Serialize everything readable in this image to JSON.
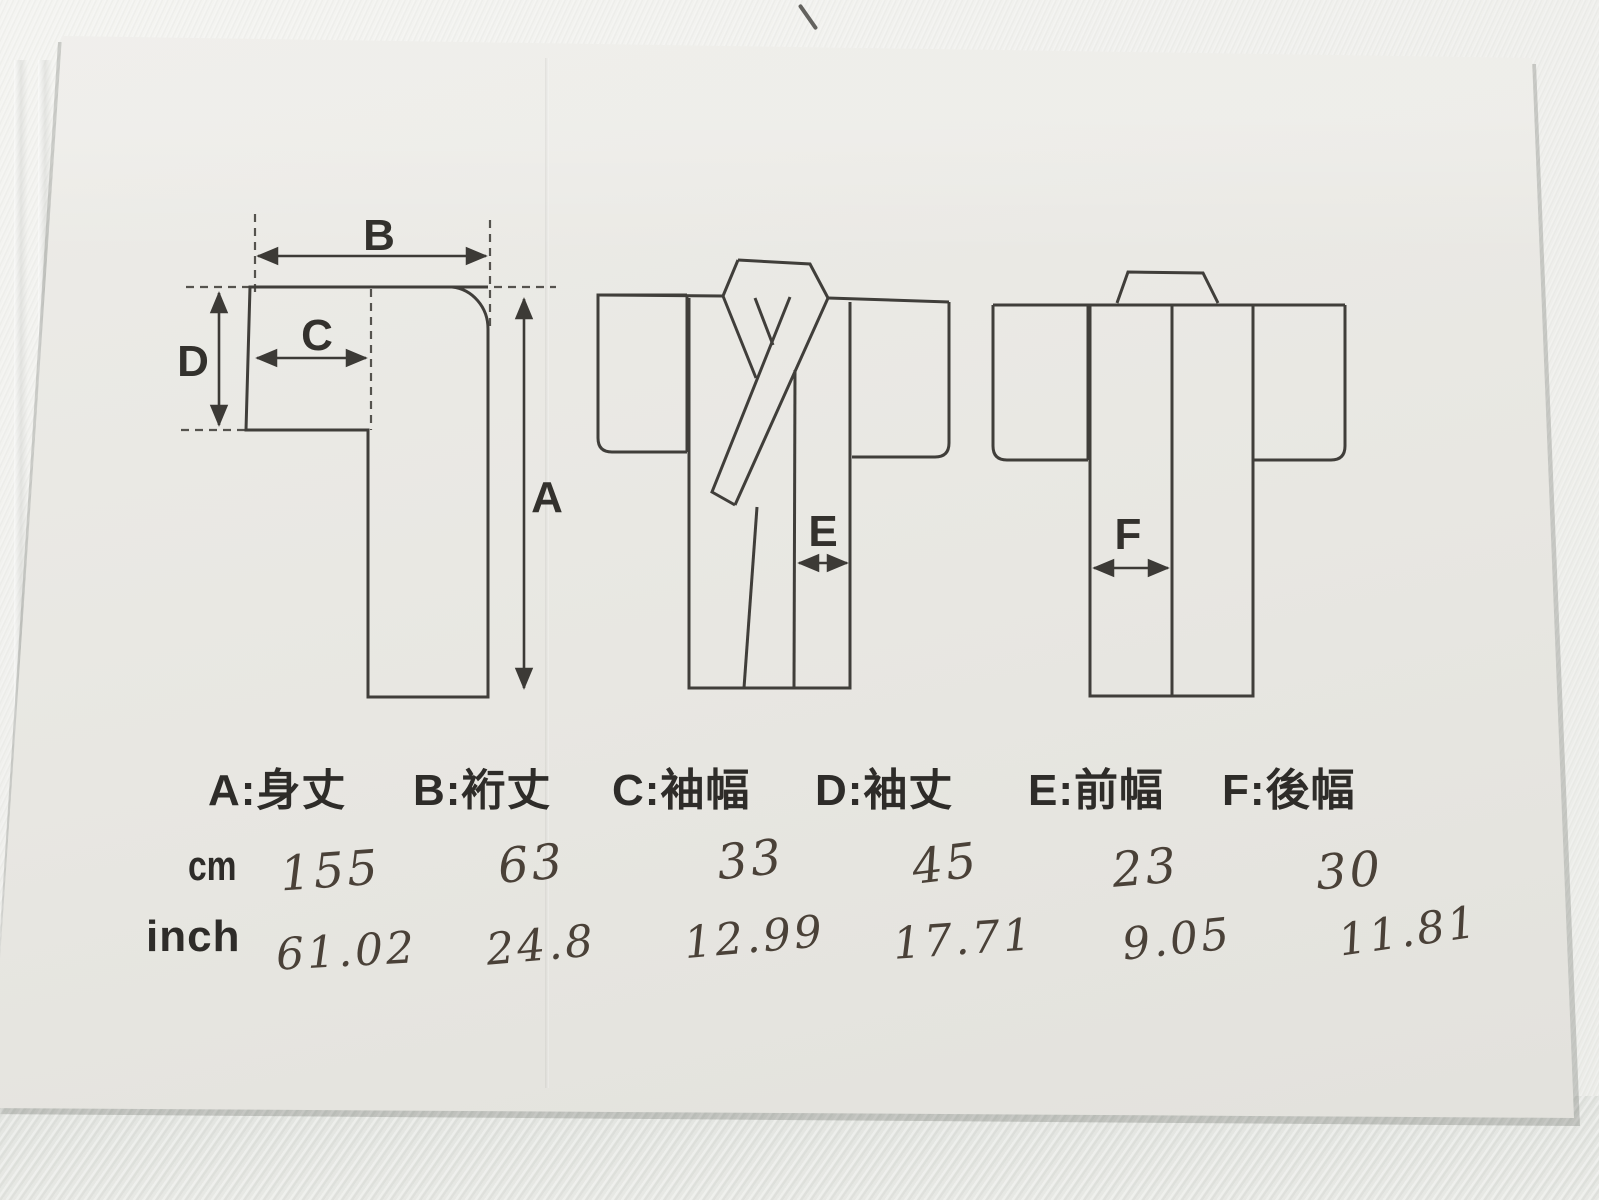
{
  "diagram": {
    "labels": {
      "a": "A",
      "b": "B",
      "c": "C",
      "d": "D",
      "e": "E",
      "f": "F"
    }
  },
  "legend": {
    "items": [
      "A:身丈",
      "B:裄丈",
      "C:袖幅",
      "D:袖丈",
      "E:前幅",
      "F:後幅"
    ]
  },
  "table": {
    "row_cm": {
      "label": "cm",
      "values": [
        "155",
        "63",
        "33",
        "45",
        "23",
        "30"
      ]
    },
    "row_inch": {
      "label": "inch",
      "values": [
        "61.02",
        "24.8",
        "12.99",
        "17.71",
        "9.05",
        "11.81"
      ]
    }
  },
  "colors": {
    "paper": "#e8e7e2",
    "fabric": "#f0f0ed",
    "ink": "#403e3a",
    "handwriting": "#4a4138"
  }
}
